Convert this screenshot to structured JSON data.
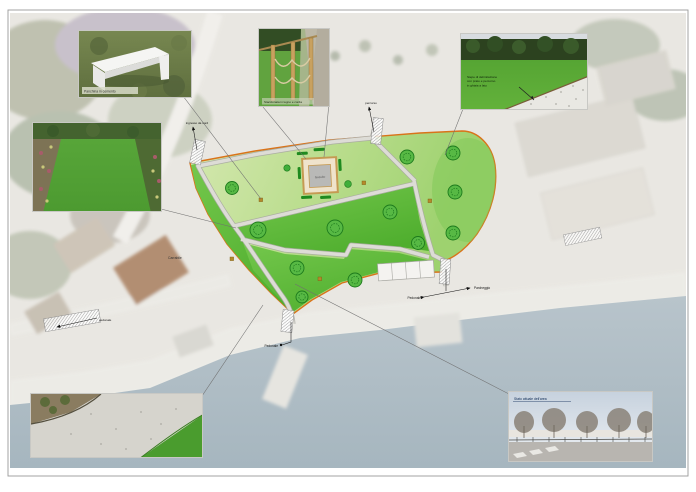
{
  "plan": {
    "labels": {
      "entrance_north": "ingresso da nord",
      "path_top": "percorso",
      "driveway": "Carrabile",
      "pedestrian_left": "pedonale",
      "pedestrian_south": "Pedonale",
      "pedestrian_right": "Pedonale",
      "parking": "Parcheggio",
      "structure": "Gazebo"
    },
    "colors": {
      "boundary": "#d9731a",
      "lawn_bright": "#5cb838",
      "lawn_pale": "#c3e09c",
      "path": "#dddcd6",
      "water": "#aebcc5"
    }
  },
  "photos": {
    "bench": {
      "caption": "Panchina in cemento"
    },
    "fence": {
      "caption": "Staccionata in legno e corda"
    },
    "hedge": {
      "caption_line1": "Siepe di delimitazione",
      "caption_line2": "con prato e percorso",
      "caption_line3": "in ghiaia a lato"
    },
    "street": {
      "caption": "Stato attuale dell'area"
    }
  }
}
